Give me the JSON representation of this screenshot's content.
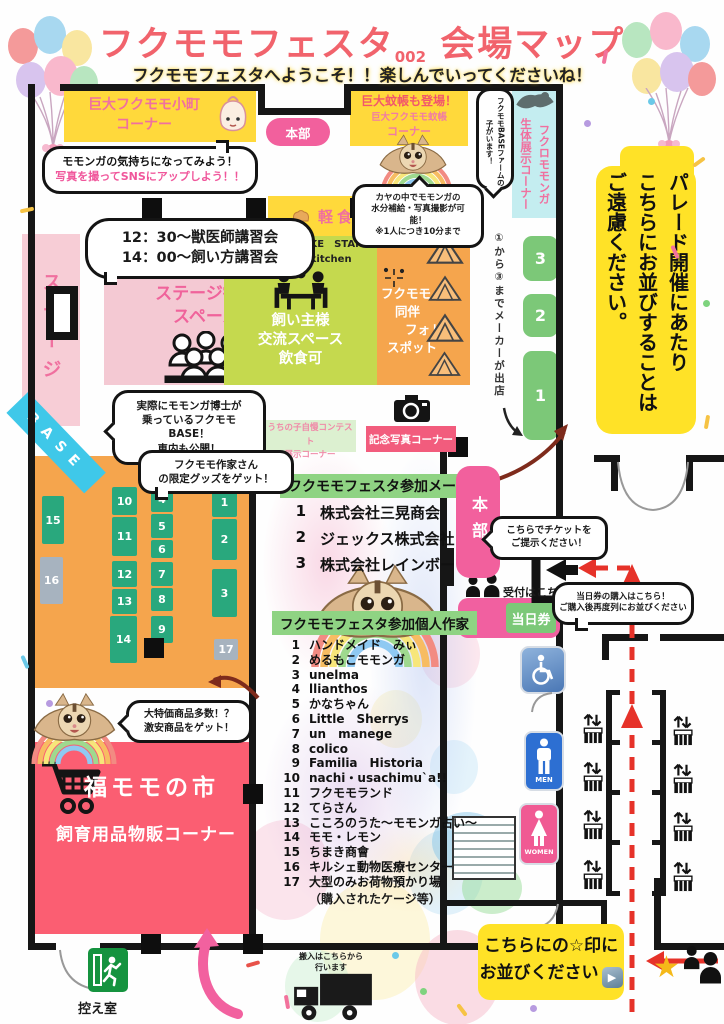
{
  "header": {
    "title_main": "フクモモフェスタ",
    "title_num": "002",
    "title_tail": "会場マップ",
    "welcome": "フクモモフェスタへようこそ！！楽しんでいってくださいね！"
  },
  "top": {
    "komachi_line1": "巨大フクモモ小町",
    "komachi_line2": "コーナー",
    "hq_top": "本部",
    "kaya_line1": "巨大蚊帳も登場！",
    "kaya_line2": "巨大フクモモ蚊帳",
    "kaya_line3": "コーナー",
    "sns_line1": "モモンガの気持ちになってみよう！",
    "sns_line2": "写真を撮ってSNSにアップしよう！！",
    "kayabubble_line1": "カヤの中でモモンガの",
    "kayabubble_line2": "水分補給・写真撮影が可能！",
    "kayabubble_line3": "※1人につき10分まで",
    "basefarm_bubble": "フクモモBASEファームの子がいます！",
    "exhibit_col1": "フクロモモンガ",
    "exhibit_col2": "生体展示コーナー"
  },
  "parade": {
    "col1": "パレード開催にあたり",
    "col2": "こちらにお並びすることは",
    "col3": "ご遠慮ください。"
  },
  "stage": {
    "strip": "ステージ",
    "lecture1": "12：30～獣医師講習会",
    "lecture2": "14：00～飼い方講習会",
    "viewing1": "ステージ観覧",
    "viewing2": "スペース"
  },
  "food": {
    "snack": "軽食",
    "stand1": "Yumenoki　BAKE　STAND",
    "stand2": "yumesora_kitchen",
    "exchange1": "飼い主様",
    "exchange2": "交流スペース",
    "exchange3": "飲食可"
  },
  "photospot": {
    "l1": "フクモモ",
    "l2": "同伴",
    "l3": "フォト",
    "l4": "スポット"
  },
  "maker_zone": {
    "note": "①から③までメーカーが出店",
    "slots": [
      {
        "label": "3",
        "x": 523,
        "y": 236,
        "w": 35,
        "h": 45
      },
      {
        "label": "2",
        "x": 523,
        "y": 294,
        "w": 35,
        "h": 43
      },
      {
        "label": "1",
        "x": 523,
        "y": 351,
        "w": 35,
        "h": 89
      }
    ]
  },
  "base": {
    "ribbon": "BASE",
    "bubble1": "実際にモモンガ博士が",
    "bubble2": "乗っているフクモモBASE！",
    "bubble3": "車内も公開！"
  },
  "goods_bubble": {
    "l1": "フクモモ作家さん",
    "l2": "の限定グッズをゲット！"
  },
  "contest": {
    "l1": "うちの子自慢コンテスト",
    "l2": "展示コーナー"
  },
  "photo_corner": "記念写真コーナー",
  "makers": {
    "header": "フクモモフェスタ参加メーカー",
    "items": [
      {
        "no": "1",
        "name": "株式会社三晃商会"
      },
      {
        "no": "2",
        "name": "ジェックス株式会社"
      },
      {
        "no": "3",
        "name": "株式会社レインボー"
      }
    ]
  },
  "artists": {
    "header": "フクモモフェスタ参加個人作家",
    "items": [
      {
        "no": "1",
        "name": "ハンドメイド　みぃ"
      },
      {
        "no": "2",
        "name": "めるもこモモンガ"
      },
      {
        "no": "3",
        "name": "unelma"
      },
      {
        "no": "4",
        "name": "llianthos"
      },
      {
        "no": "5",
        "name": "かなちゃん"
      },
      {
        "no": "6",
        "name": "Little　Sherrys"
      },
      {
        "no": "7",
        "name": "un　manege"
      },
      {
        "no": "8",
        "name": "colico"
      },
      {
        "no": "9",
        "name": "Familia　Historia"
      },
      {
        "no": "10",
        "name": "nachi・usachimu`a!!"
      },
      {
        "no": "11",
        "name": "フクモモランド"
      },
      {
        "no": "12",
        "name": "てらさん"
      },
      {
        "no": "13",
        "name": "こころのうた～モモンガ占い～"
      },
      {
        "no": "14",
        "name": "モモ・レモン"
      },
      {
        "no": "15",
        "name": "ちまき商會"
      },
      {
        "no": "16",
        "name": "キルシェ動物医療センター"
      },
      {
        "no": "17",
        "name": "大型のみお荷物預かり場"
      }
    ],
    "note": "（購入されたケージ等）"
  },
  "booths": [
    {
      "n": "15",
      "x": 42,
      "y": 496,
      "w": 22,
      "h": 48,
      "c": ""
    },
    {
      "n": "16",
      "x": 40,
      "y": 557,
      "w": 23,
      "h": 47,
      "c": "gray"
    },
    {
      "n": "10",
      "x": 112,
      "y": 487,
      "w": 25,
      "h": 28,
      "c": ""
    },
    {
      "n": "11",
      "x": 112,
      "y": 517,
      "w": 25,
      "h": 39,
      "c": ""
    },
    {
      "n": "12",
      "x": 112,
      "y": 561,
      "w": 25,
      "h": 26,
      "c": ""
    },
    {
      "n": "13",
      "x": 112,
      "y": 589,
      "w": 25,
      "h": 25,
      "c": ""
    },
    {
      "n": "14",
      "x": 110,
      "y": 616,
      "w": 27,
      "h": 47,
      "c": ""
    },
    {
      "n": "4",
      "x": 151,
      "y": 486,
      "w": 22,
      "h": 26,
      "c": ""
    },
    {
      "n": "5",
      "x": 151,
      "y": 514,
      "w": 22,
      "h": 24,
      "c": ""
    },
    {
      "n": "6",
      "x": 151,
      "y": 540,
      "w": 22,
      "h": 18,
      "c": ""
    },
    {
      "n": "7",
      "x": 151,
      "y": 562,
      "w": 22,
      "h": 24,
      "c": ""
    },
    {
      "n": "8",
      "x": 151,
      "y": 588,
      "w": 22,
      "h": 23,
      "c": ""
    },
    {
      "n": "9",
      "x": 151,
      "y": 616,
      "w": 22,
      "h": 27,
      "c": ""
    },
    {
      "n": "1",
      "x": 212,
      "y": 487,
      "w": 25,
      "h": 30,
      "c": ""
    },
    {
      "n": "2",
      "x": 212,
      "y": 519,
      "w": 25,
      "h": 41,
      "c": ""
    },
    {
      "n": "3",
      "x": 212,
      "y": 569,
      "w": 25,
      "h": 48,
      "c": ""
    },
    {
      "n": "17",
      "x": 214,
      "y": 639,
      "w": 24,
      "h": 21,
      "c": "gray"
    }
  ],
  "hq_side": "本部",
  "tickets": {
    "present1": "こちらでチケットを",
    "present2": "ご提示ください！",
    "reception": "受付はこちら",
    "day_ticket": "当日券",
    "buy1": "当日券の購入はこちら！",
    "buy2": "ご購入後再度列にお並びください"
  },
  "market": {
    "title": "福モモの市",
    "subtitle": "飼育用品物販コーナー",
    "bubble1": "大特価商品多数！？",
    "bubble2": "激安商品をゲット！"
  },
  "bottom": {
    "waiting_room": "控え室",
    "carryin1": "搬入はこちらから",
    "carryin2": "行います",
    "lineup1": "こちらにの☆印に",
    "lineup2": "お並びください",
    "play": "▶",
    "star": "★"
  },
  "restrooms": {
    "men": "MEN",
    "women": "WOMEN"
  },
  "colors": {
    "accent_pink": "#f2609d",
    "yellow": "#ffdc3a",
    "orange": "#f5a54d",
    "lime": "#c5d94e",
    "booth_green": "#29a87d",
    "market_pink": "#fb5e72",
    "red_path": "#e63229"
  }
}
